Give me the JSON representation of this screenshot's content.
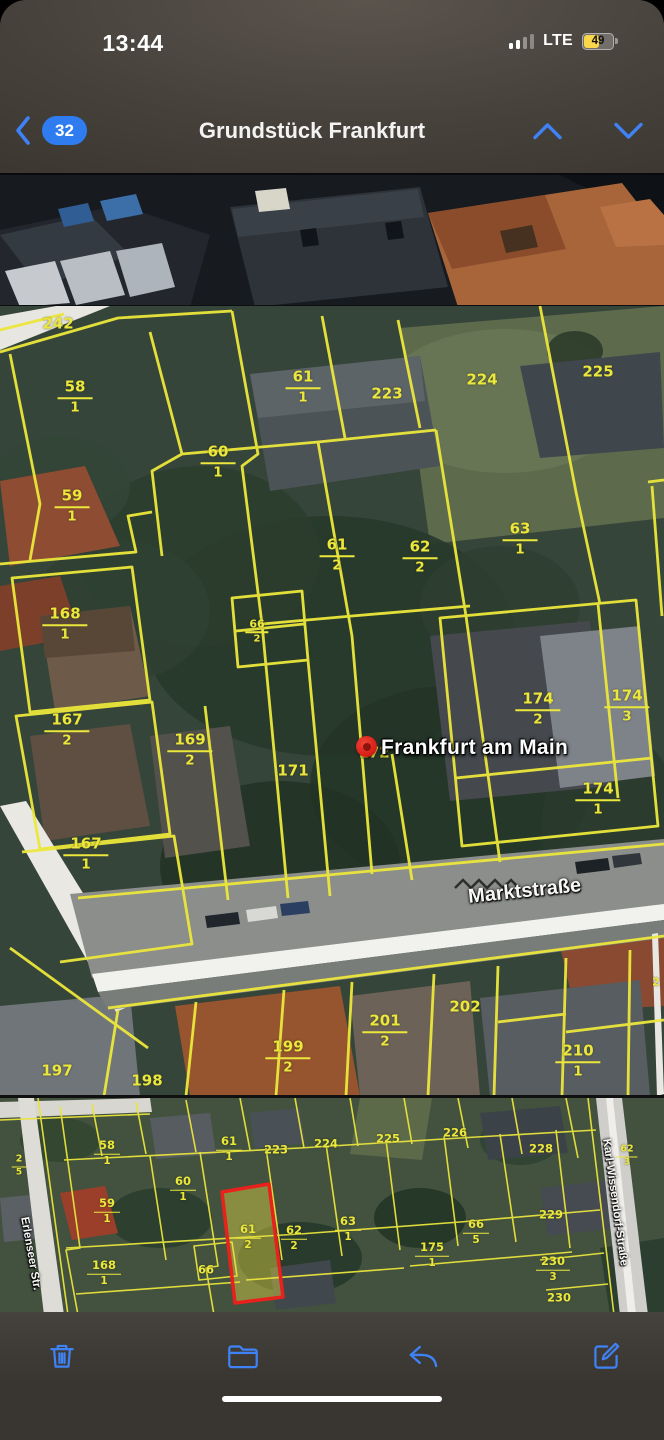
{
  "status_bar": {
    "time": "13:44",
    "network": "LTE",
    "battery_percent": "49"
  },
  "nav_bar": {
    "back_unread_count": "32",
    "title": "Grundstück Frankfurt"
  },
  "map_main": {
    "pin_label": "Frankfurt am Main",
    "street": "Marktstraße",
    "parcels": [
      {
        "n": "242",
        "x": 58,
        "y": 18
      },
      {
        "n": "58",
        "d": "1",
        "x": 75,
        "y": 91
      },
      {
        "n": "61",
        "d": "1",
        "x": 303,
        "y": 81
      },
      {
        "n": "223",
        "x": 387,
        "y": 88
      },
      {
        "n": "224",
        "x": 482,
        "y": 74
      },
      {
        "n": "225",
        "x": 598,
        "y": 66
      },
      {
        "n": "59",
        "d": "1",
        "x": 72,
        "y": 200
      },
      {
        "n": "60",
        "d": "1",
        "x": 218,
        "y": 156
      },
      {
        "n": "61",
        "d": "2",
        "x": 337,
        "y": 249
      },
      {
        "n": "62",
        "d": "2",
        "x": 420,
        "y": 251
      },
      {
        "n": "63",
        "d": "1",
        "x": 520,
        "y": 233
      },
      {
        "n": "168",
        "d": "1",
        "x": 65,
        "y": 318
      },
      {
        "n": "66",
        "d": "2",
        "x": 257,
        "y": 325,
        "s": true
      },
      {
        "n": "167",
        "d": "2",
        "x": 67,
        "y": 424
      },
      {
        "n": "169",
        "d": "2",
        "x": 190,
        "y": 444
      },
      {
        "n": "171",
        "x": 293,
        "y": 465
      },
      {
        "n": "172",
        "x": 374,
        "y": 447
      },
      {
        "n": "174",
        "d": "2",
        "x": 538,
        "y": 403
      },
      {
        "n": "174",
        "d": "3",
        "x": 627,
        "y": 400
      },
      {
        "n": "174",
        "d": "1",
        "x": 598,
        "y": 493
      },
      {
        "n": "167",
        "d": "1",
        "x": 86,
        "y": 548
      },
      {
        "n": "197",
        "x": 57,
        "y": 765
      },
      {
        "n": "198",
        "x": 147,
        "y": 775
      },
      {
        "n": "199",
        "d": "2",
        "x": 288,
        "y": 751
      },
      {
        "n": "201",
        "d": "2",
        "x": 385,
        "y": 725
      },
      {
        "n": "202",
        "x": 465,
        "y": 701
      },
      {
        "n": "210",
        "d": "1",
        "x": 578,
        "y": 755
      },
      {
        "n": "2",
        "x": 656,
        "y": 676,
        "s": true
      }
    ]
  },
  "map_overview": {
    "street_left": "Erlenseer Str.",
    "street_right": "Karl-Wissendorf-Straße",
    "parcels": [
      {
        "n": "58",
        "d": "1",
        "x": 107,
        "y": 55
      },
      {
        "n": "61",
        "d": "1",
        "x": 229,
        "y": 51
      },
      {
        "n": "223",
        "x": 276,
        "y": 52
      },
      {
        "n": "224",
        "x": 326,
        "y": 46
      },
      {
        "n": "225",
        "x": 388,
        "y": 41
      },
      {
        "n": "226",
        "x": 455,
        "y": 35
      },
      {
        "n": "228",
        "x": 541,
        "y": 51
      },
      {
        "n": "59",
        "d": "1",
        "x": 107,
        "y": 113
      },
      {
        "n": "60",
        "d": "1",
        "x": 183,
        "y": 91
      },
      {
        "n": "61",
        "d": "2",
        "x": 248,
        "y": 139,
        "hl": true
      },
      {
        "n": "62",
        "d": "2",
        "x": 294,
        "y": 140
      },
      {
        "n": "63",
        "d": "1",
        "x": 348,
        "y": 131
      },
      {
        "n": "66",
        "x": 206,
        "y": 172
      },
      {
        "n": "168",
        "d": "1",
        "x": 104,
        "y": 175
      },
      {
        "n": "66",
        "d": "5",
        "x": 476,
        "y": 134
      },
      {
        "n": "175",
        "d": "1",
        "x": 432,
        "y": 157
      },
      {
        "n": "229",
        "x": 551,
        "y": 117
      },
      {
        "n": "230",
        "d": "3",
        "x": 553,
        "y": 171
      },
      {
        "n": "230",
        "x": 559,
        "y": 200
      },
      {
        "n": "62",
        "d": "3",
        "x": 627,
        "y": 58,
        "s": true
      },
      {
        "n": "2",
        "d": "5",
        "x": 19,
        "y": 68,
        "s": true
      }
    ]
  },
  "toolbar": {
    "buttons": [
      "delete",
      "move-to-folder",
      "reply",
      "compose"
    ]
  },
  "colors": {
    "accent_blue": "#3e82f6",
    "parcel_yellow": "#ece73b",
    "highlight_red": "#e8211c",
    "battery_yellow": "#f9d64a"
  }
}
